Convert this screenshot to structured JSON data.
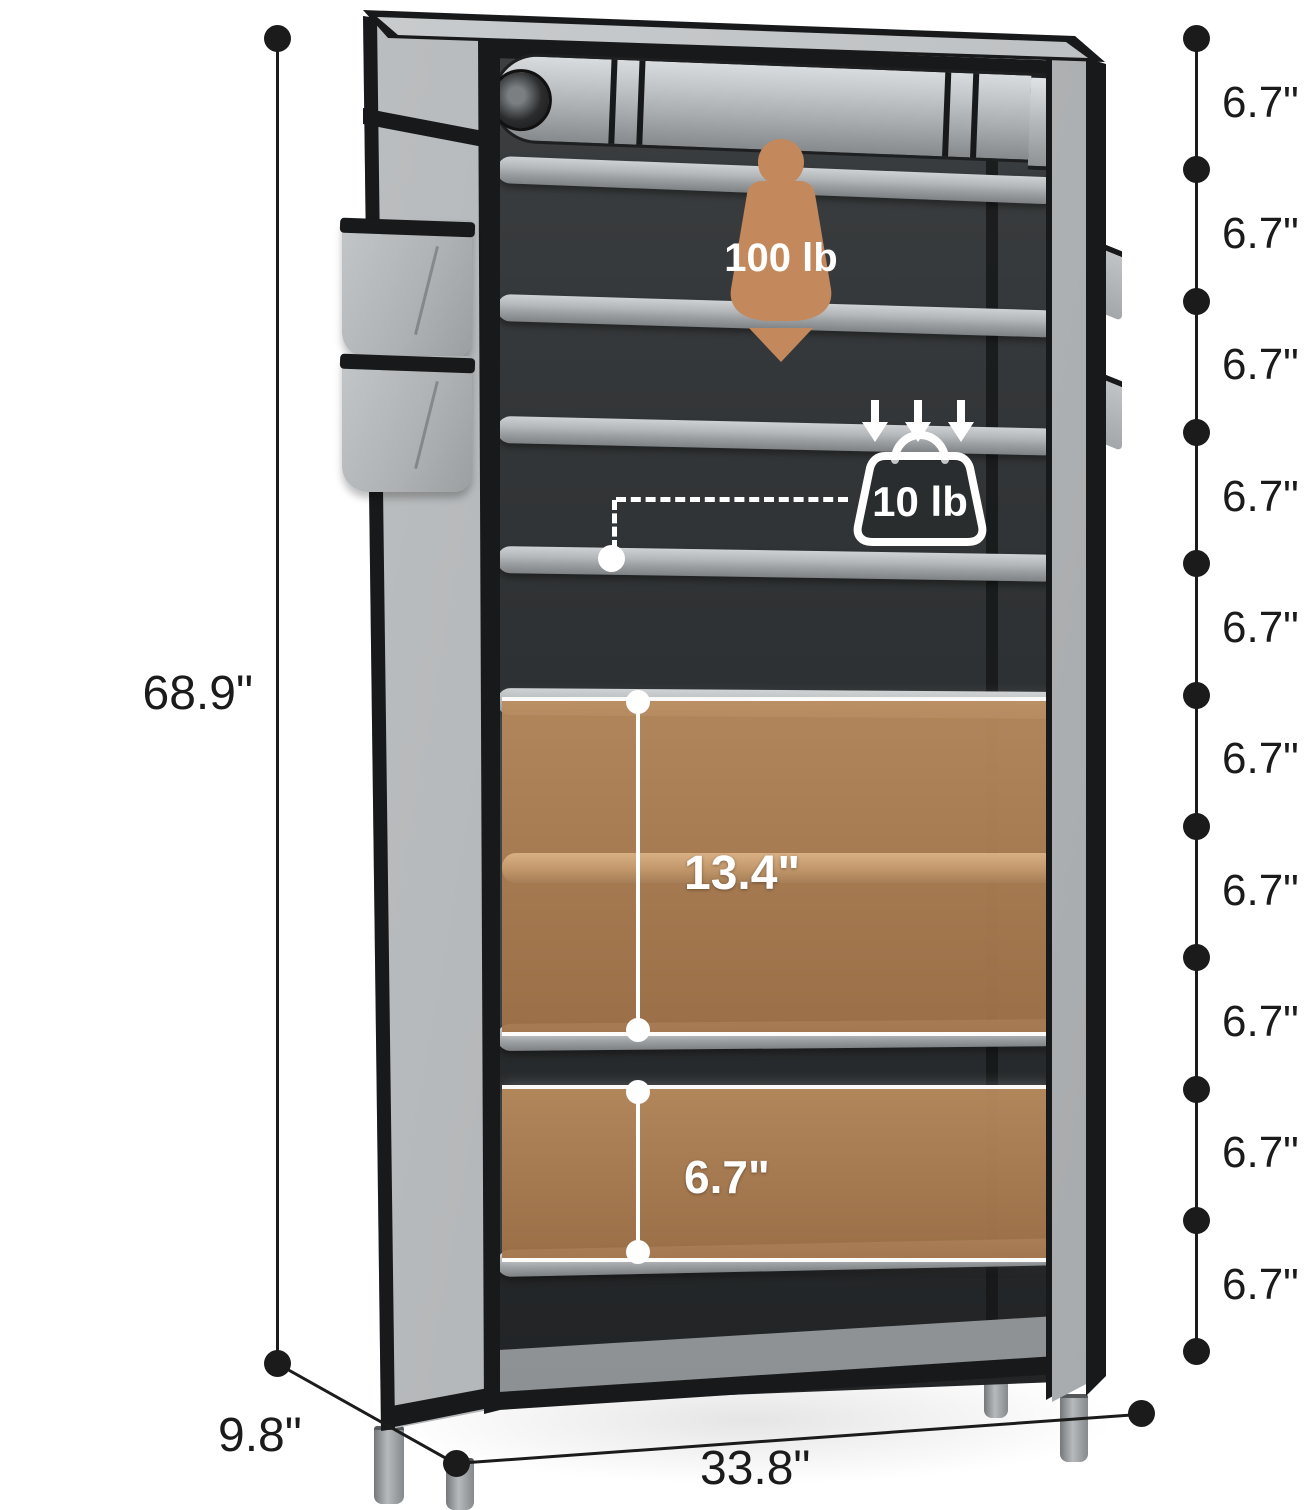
{
  "dimensions": {
    "height": "68.9\"",
    "depth": "9.8\"",
    "width": "33.8\"",
    "tier_labels": [
      "6.7\"",
      "6.7\"",
      "6.7\"",
      "6.7\"",
      "6.7\"",
      "6.7\"",
      "6.7\"",
      "6.7\"",
      "6.7\"",
      "6.7\""
    ]
  },
  "interior": {
    "large_compartment_height": "13.4\"",
    "small_compartment_height": "6.7\""
  },
  "capacity": {
    "total": "100 lb",
    "per_shelf": "10 lb"
  },
  "icons": {
    "total_capacity": "weight-silhouette-icon",
    "per_shelf_capacity": "weight-outline-icon",
    "load_direction": "down-arrow-icon"
  },
  "colors": {
    "accent_tan": "#c3895c",
    "overlay_brown": "#b08358",
    "fabric_grey": "#b6b9bb",
    "trim_black": "#17191b",
    "dimension_black": "#1b1b1b",
    "highlight_white": "#ffffff"
  }
}
